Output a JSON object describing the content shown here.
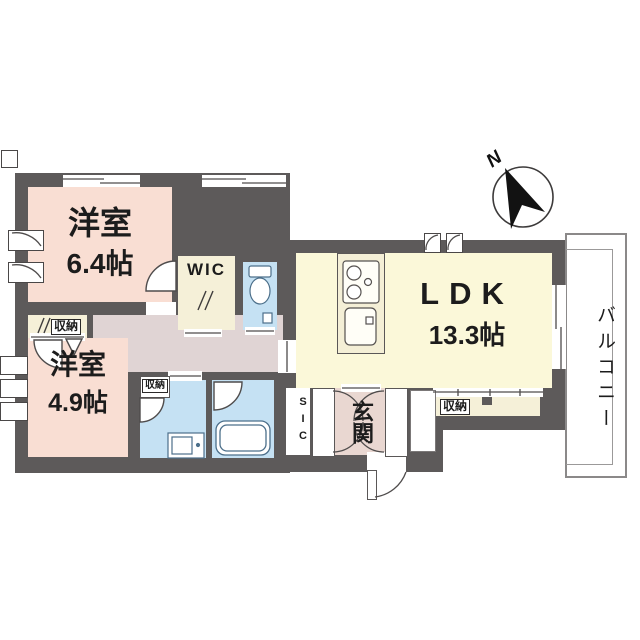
{
  "compass": {
    "label": "N"
  },
  "balcony": {
    "label": "バルコニー"
  },
  "rooms": {
    "bedroom1": {
      "name": "洋室",
      "size": "6.4帖"
    },
    "bedroom2": {
      "name": "洋室",
      "size": "4.9帖"
    },
    "ldk": {
      "name": "LDK",
      "size": "13.3帖"
    },
    "wic": {
      "label": "WIC"
    },
    "sic": {
      "label": "SIC"
    },
    "entrance": {
      "label": "玄関"
    }
  },
  "storage": {
    "closet_bedroom2": {
      "label": "収納"
    },
    "closet_washroom": {
      "label": "収納"
    },
    "closet_ldk": {
      "label": "収納"
    }
  },
  "colors": {
    "wall": "#5d5a5a",
    "bedroom_floor": "#f9ded3",
    "ldk_floor": "#fbf8d9",
    "storage_floor": "#f5f0d8",
    "wet_area_floor": "#c5e1f3",
    "hallway_floor": "#e0d4d4",
    "entrance_floor": "#e9d7d1",
    "balcony_floor": "#ffffff"
  }
}
